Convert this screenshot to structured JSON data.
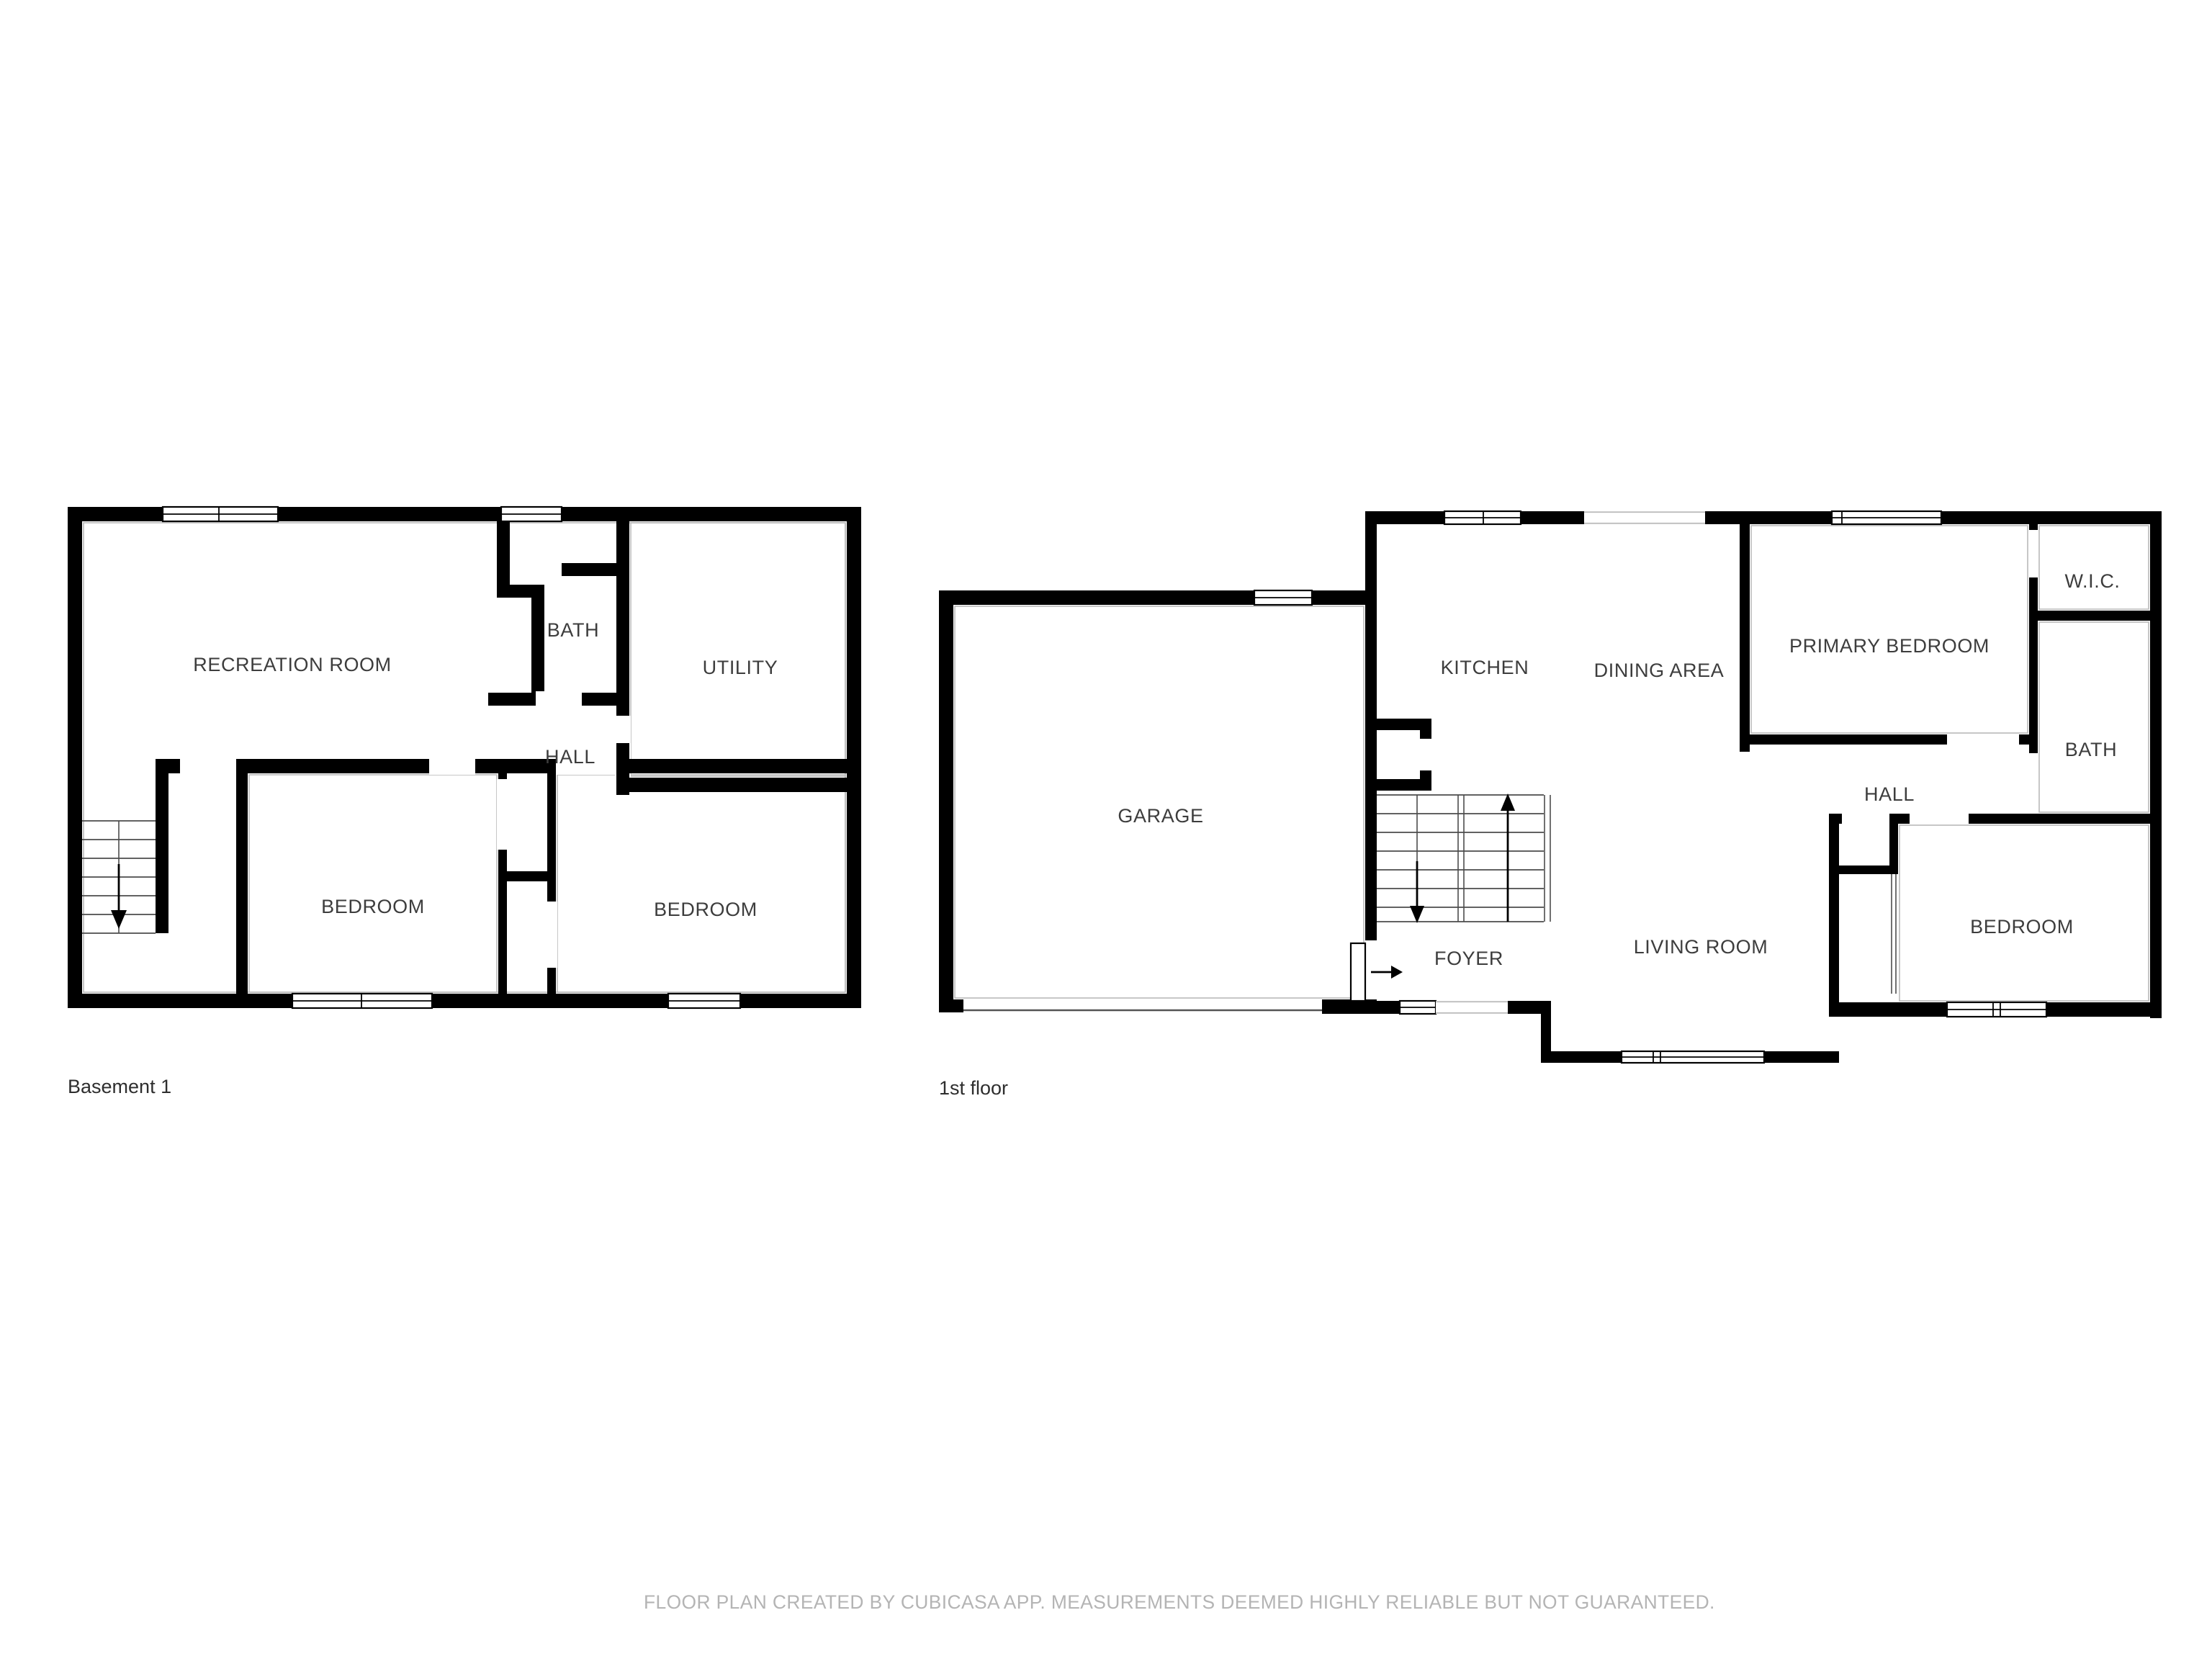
{
  "page": {
    "background": "#ffffff"
  },
  "colors": {
    "wall": "#000000",
    "room_label": "#3d3d3d",
    "floor_label": "#2e2e2e",
    "footer_text": "#b4b4b4",
    "hairline": "#b9b9b9"
  },
  "floors": [
    {
      "label": "Basement 1",
      "rooms": [
        {
          "name": "RECREATION ROOM"
        },
        {
          "name": "BATH"
        },
        {
          "name": "UTILITY"
        },
        {
          "name": "HALL"
        },
        {
          "name": "BEDROOM"
        },
        {
          "name": "BEDROOM"
        }
      ],
      "icons": [
        "stairs-down-arrow"
      ]
    },
    {
      "label": "1st floor",
      "rooms": [
        {
          "name": "GARAGE"
        },
        {
          "name": "KITCHEN"
        },
        {
          "name": "DINING AREA"
        },
        {
          "name": "PRIMARY BEDROOM"
        },
        {
          "name": "W.I.C."
        },
        {
          "name": "BATH"
        },
        {
          "name": "HALL"
        },
        {
          "name": "LIVING ROOM"
        },
        {
          "name": "FOYER"
        },
        {
          "name": "BEDROOM"
        }
      ],
      "icons": [
        "stairs-up-arrow",
        "stairs-down-arrow",
        "entry-door-arrow"
      ]
    }
  ],
  "footer": {
    "text": "FLOOR PLAN CREATED BY CUBICASA APP. MEASUREMENTS DEEMED HIGHLY RELIABLE BUT NOT GUARANTEED."
  }
}
